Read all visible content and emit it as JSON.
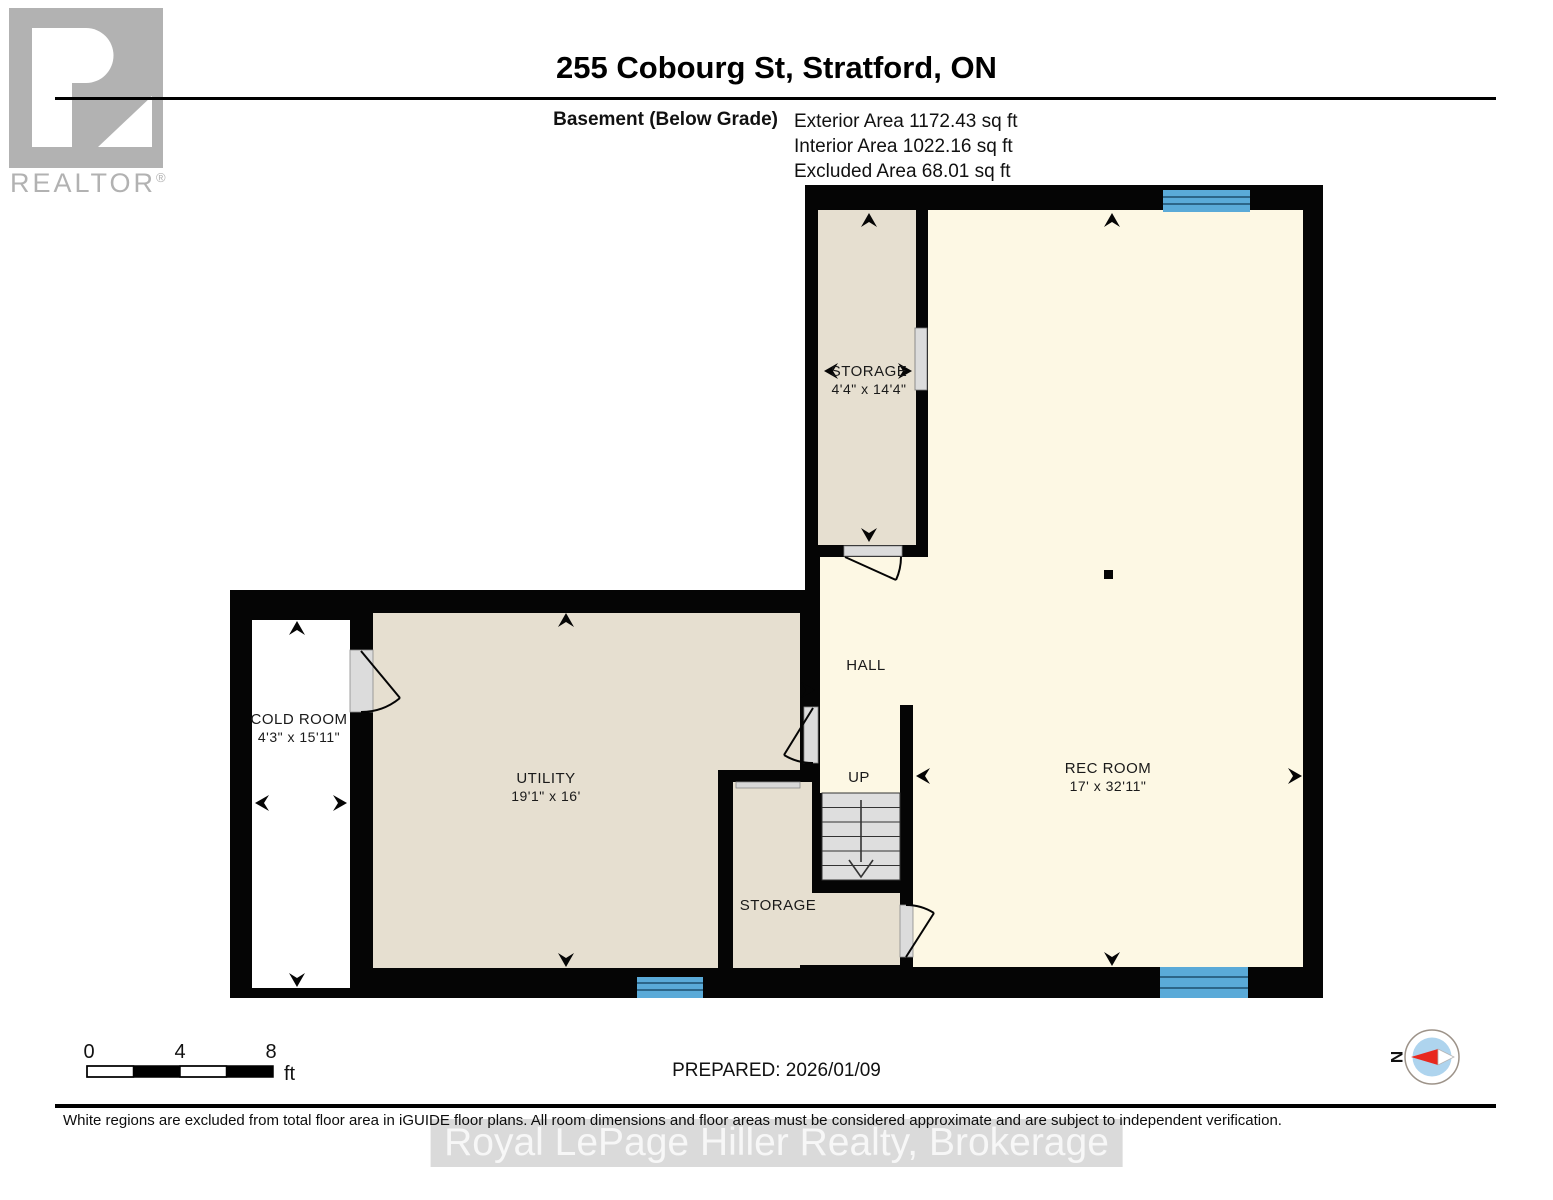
{
  "header": {
    "title": "255 Cobourg St, Stratford, ON",
    "floor_label": "Basement (Below Grade)",
    "areas": {
      "exterior": "Exterior Area 1172.43 sq ft",
      "interior": "Interior Area 1022.16 sq ft",
      "excluded": "Excluded Area 68.01 sq ft"
    }
  },
  "logo": {
    "brand": "REALTOR",
    "reg": "®"
  },
  "rooms": {
    "storage_top": {
      "name": "STORAGE",
      "dims": "4'4\" x 14'4\""
    },
    "cold_room": {
      "name": "COLD ROOM",
      "dims": "4'3\" x 15'11\""
    },
    "utility": {
      "name": "UTILITY",
      "dims": "19'1\" x 16'"
    },
    "hall": {
      "name": "HALL"
    },
    "stairs": {
      "label": "UP"
    },
    "storage_bottom": {
      "name": "STORAGE"
    },
    "rec_room": {
      "name": "REC ROOM",
      "dims": "17' x 32'11\""
    }
  },
  "scale_bar": {
    "tick0": "0",
    "tick4": "4",
    "tick8": "8",
    "unit": "ft"
  },
  "prepared": "PREPARED: 2026/01/09",
  "compass": {
    "north": "N"
  },
  "footer": {
    "disclaimer": "White regions are excluded from total floor area in iGUIDE floor plans. All room dimensions and floor areas must be considered approximate and are subject to independent verification."
  },
  "watermark": "Royal LePage Hiller Realty, Brokerage",
  "colors": {
    "wall": "#050505",
    "room_beige": "#e6dfd0",
    "room_cream": "#fdf8e4",
    "excluded_white": "#ffffff",
    "window_blue": "#5aaad8",
    "door_gray": "#dcdcdc"
  }
}
